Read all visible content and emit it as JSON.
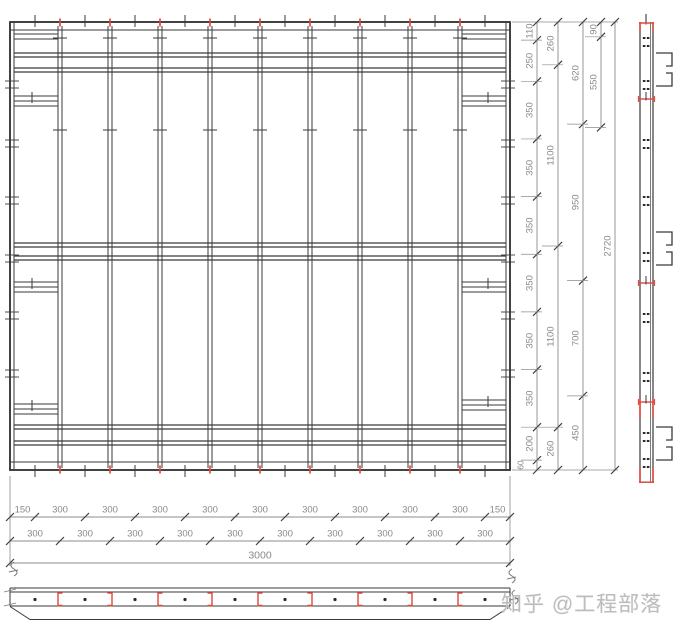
{
  "watermark": {
    "text": "知乎 @工程部落"
  },
  "colors": {
    "line": "#3a3a3a",
    "border": "#2e2e2e",
    "dim": "#8c8c8c",
    "dim_text": "#8a8a8a",
    "tick": "#3f3f3f",
    "red": "#e2483d",
    "dot": "#2a2a2a",
    "squiggle": "#777777",
    "watermark": "#bdbdbd"
  },
  "plan": {
    "x": 10,
    "y": 22,
    "w": 500,
    "h": 448,
    "joist_xs": [
      60,
      110,
      160,
      210,
      260,
      310,
      360,
      410,
      460
    ],
    "tick_xs": [
      35,
      85,
      135,
      185,
      235,
      285,
      335,
      385,
      435,
      485
    ],
    "waler_ys": [
      53,
      68,
      243,
      256,
      425,
      441
    ],
    "joist_cross_tick_ys": [
      38,
      130
    ],
    "border_tick_ys": [
      81,
      140,
      197,
      255,
      312,
      370
    ],
    "stub_rows_left": [
      {
        "y": 34,
        "lines": 2
      },
      {
        "y": 96,
        "lines": 3
      },
      {
        "y": 282,
        "lines": 3
      },
      {
        "y": 404,
        "lines": 3
      }
    ],
    "stub_rows_right": [
      {
        "y": 34,
        "lines": 2
      },
      {
        "y": 96,
        "lines": 3
      },
      {
        "y": 282,
        "lines": 3
      },
      {
        "y": 400,
        "lines": 3
      }
    ]
  },
  "right_dims": {
    "total": 2720,
    "chains": [
      {
        "x": 537,
        "segments": [
          110,
          250,
          350,
          350,
          350,
          350,
          350,
          350,
          200,
          60
        ]
      },
      {
        "x": 558,
        "segments": [
          260,
          1100,
          1100,
          260
        ]
      },
      {
        "x": 583,
        "segments": [
          620,
          950,
          700,
          450
        ]
      },
      {
        "x": 601,
        "segments": [
          90,
          550
        ],
        "partial": true
      },
      {
        "x": 615,
        "segments": [
          2720
        ]
      }
    ]
  },
  "bottom_dims": {
    "total": 3000,
    "rows": [
      {
        "y": 517,
        "segments": [
          150,
          300,
          300,
          300,
          300,
          300,
          300,
          300,
          300,
          300,
          150
        ]
      },
      {
        "y": 541,
        "segments": [
          300,
          300,
          300,
          300,
          300,
          300,
          300,
          300,
          300,
          300
        ]
      },
      {
        "y": 563,
        "segments": [
          3000
        ]
      }
    ]
  },
  "elevation": {
    "x1": 640,
    "x2": 653,
    "inner_x": 650.5,
    "y1": 22,
    "y2": 483,
    "dot_rows_y": [
      37,
      45,
      80,
      88,
      139,
      147,
      196,
      204,
      252,
      260,
      313,
      321,
      372,
      380,
      432,
      440,
      458,
      466
    ],
    "red_cross_ys": [
      99,
      283,
      402
    ],
    "red_side_segments": [
      [
        22,
        31
      ],
      [
        399,
        418
      ],
      [
        468,
        483
      ]
    ],
    "channel_clusters_y": [
      53,
      232,
      427
    ]
  },
  "strip": {
    "x1": 10,
    "x2": 510,
    "top_y": 588,
    "bar_top": 592,
    "bar_bot": 606,
    "chamfer_bot": 619.5,
    "dot_y": 599.5
  }
}
